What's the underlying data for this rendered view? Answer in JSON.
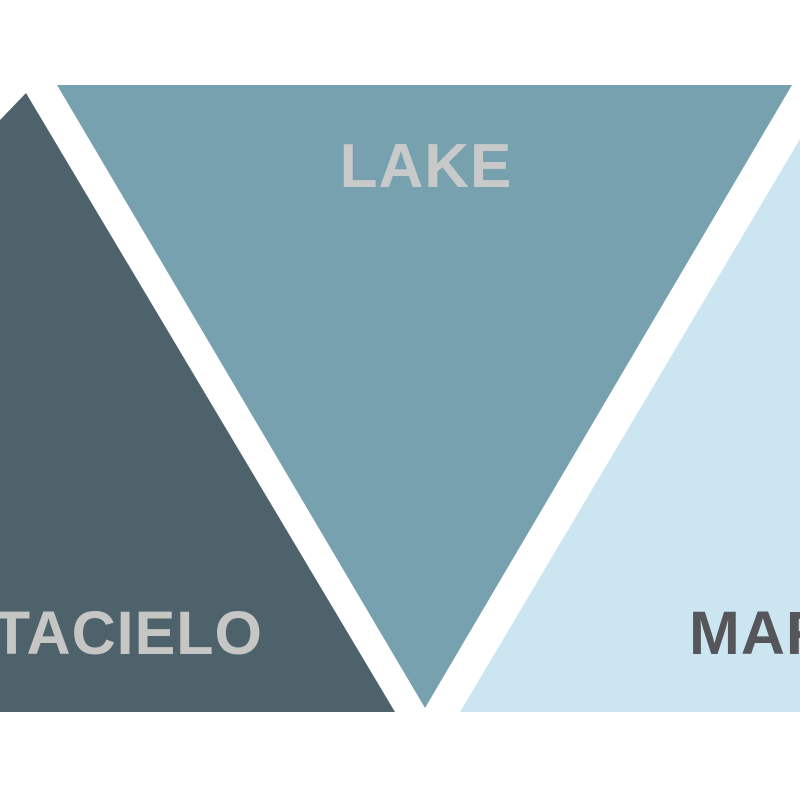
{
  "page": {
    "background": "#ffffff",
    "kind": "color-palette-triangle-graphic"
  },
  "palette": {
    "swatches": [
      {
        "name": "grattacielo",
        "full_label": "GRATTACIELO",
        "visible_text": "TACIELO",
        "fill": "#4e626b",
        "label_color": "#c6c6c4",
        "shape": "upward-triangle-cropped-left"
      },
      {
        "name": "lake",
        "full_label": "LAKE",
        "visible_text": "LAKE",
        "fill": "#77a1ae",
        "label_color": "#c7cac9",
        "shape": "downward-triangle"
      },
      {
        "name": "mare",
        "full_label": "MARE",
        "visible_text": "MA",
        "fill": "#cbe6f0",
        "label_color": "#56565a",
        "shape": "upward-triangle-cropped-right"
      }
    ]
  }
}
